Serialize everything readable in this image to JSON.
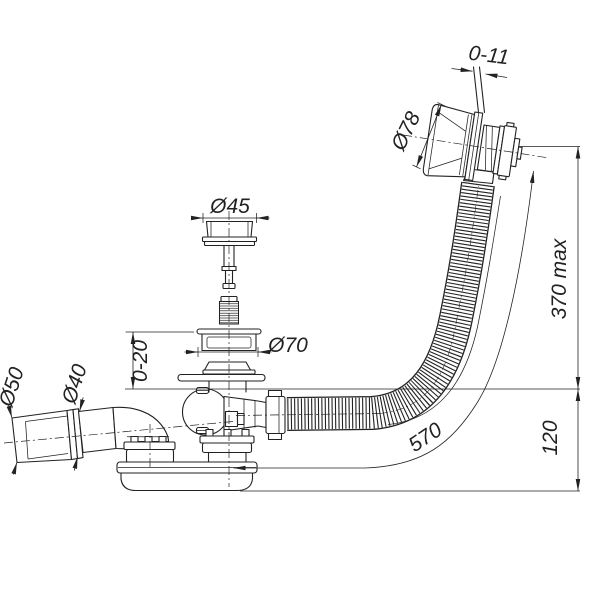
{
  "drawing": {
    "type": "technical-drawing",
    "subject": "bath-waste-overflow-and-trap-assembly",
    "labels": {
      "wall_thickness": "0-11",
      "overflow_cap_diameter": "Ø78",
      "plug_diameter": "Ø45",
      "waste_flange_diameter": "Ø70",
      "flange_height_range": "0-20",
      "outlet_socket_diameter": "Ø50",
      "outlet_pipe_diameter": "Ø40",
      "overflow_max_height": "370 max",
      "trap_depth": "120",
      "hose_length": "570"
    },
    "colors": {
      "line": "#222222",
      "background": "#ffffff"
    }
  }
}
